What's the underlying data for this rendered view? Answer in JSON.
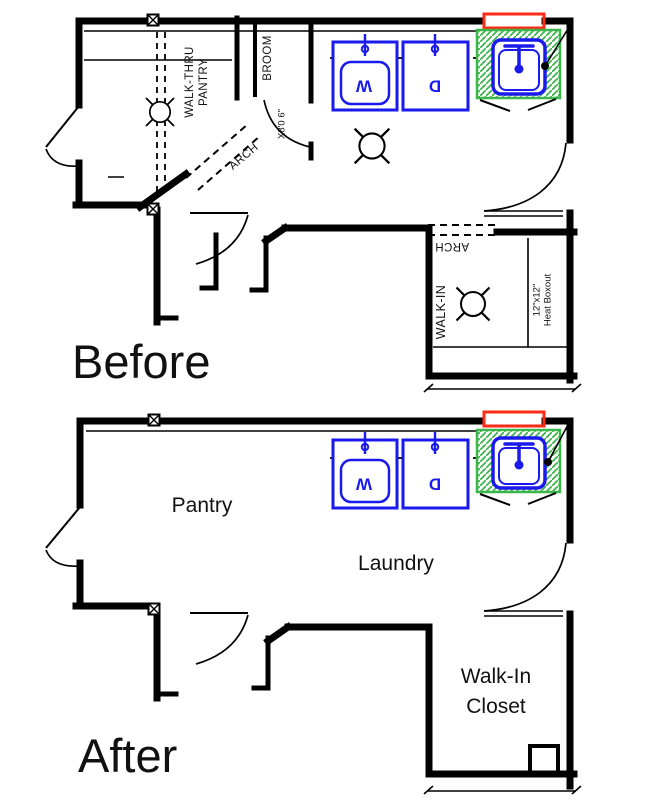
{
  "colors": {
    "wall": "#000000",
    "fixture": "#1a1aec",
    "counter": "#3cb54a",
    "window": "#fb2b16",
    "text": "#111111"
  },
  "before": {
    "title": "Before",
    "rooms": {
      "walk_thru_l1": "WALK-THRU",
      "walk_thru_l2": "PANTRY",
      "broom": "BROOM",
      "walk_in": "WALK-IN"
    },
    "annotations": {
      "arch_pantry": "ARCH",
      "arch_walk_in": "ARCH",
      "door_size": "X8'0 6\"",
      "heat_l1": "12\"x12\"",
      "heat_l2": "Heat Boxout"
    },
    "fixtures": {
      "washer": "W",
      "dryer": "D"
    }
  },
  "after": {
    "title": "After",
    "rooms": {
      "pantry": "Pantry",
      "laundry": "Laundry",
      "closet_l1": "Walk-In",
      "closet_l2": "Closet"
    },
    "fixtures": {
      "washer": "W",
      "dryer": "D"
    }
  }
}
